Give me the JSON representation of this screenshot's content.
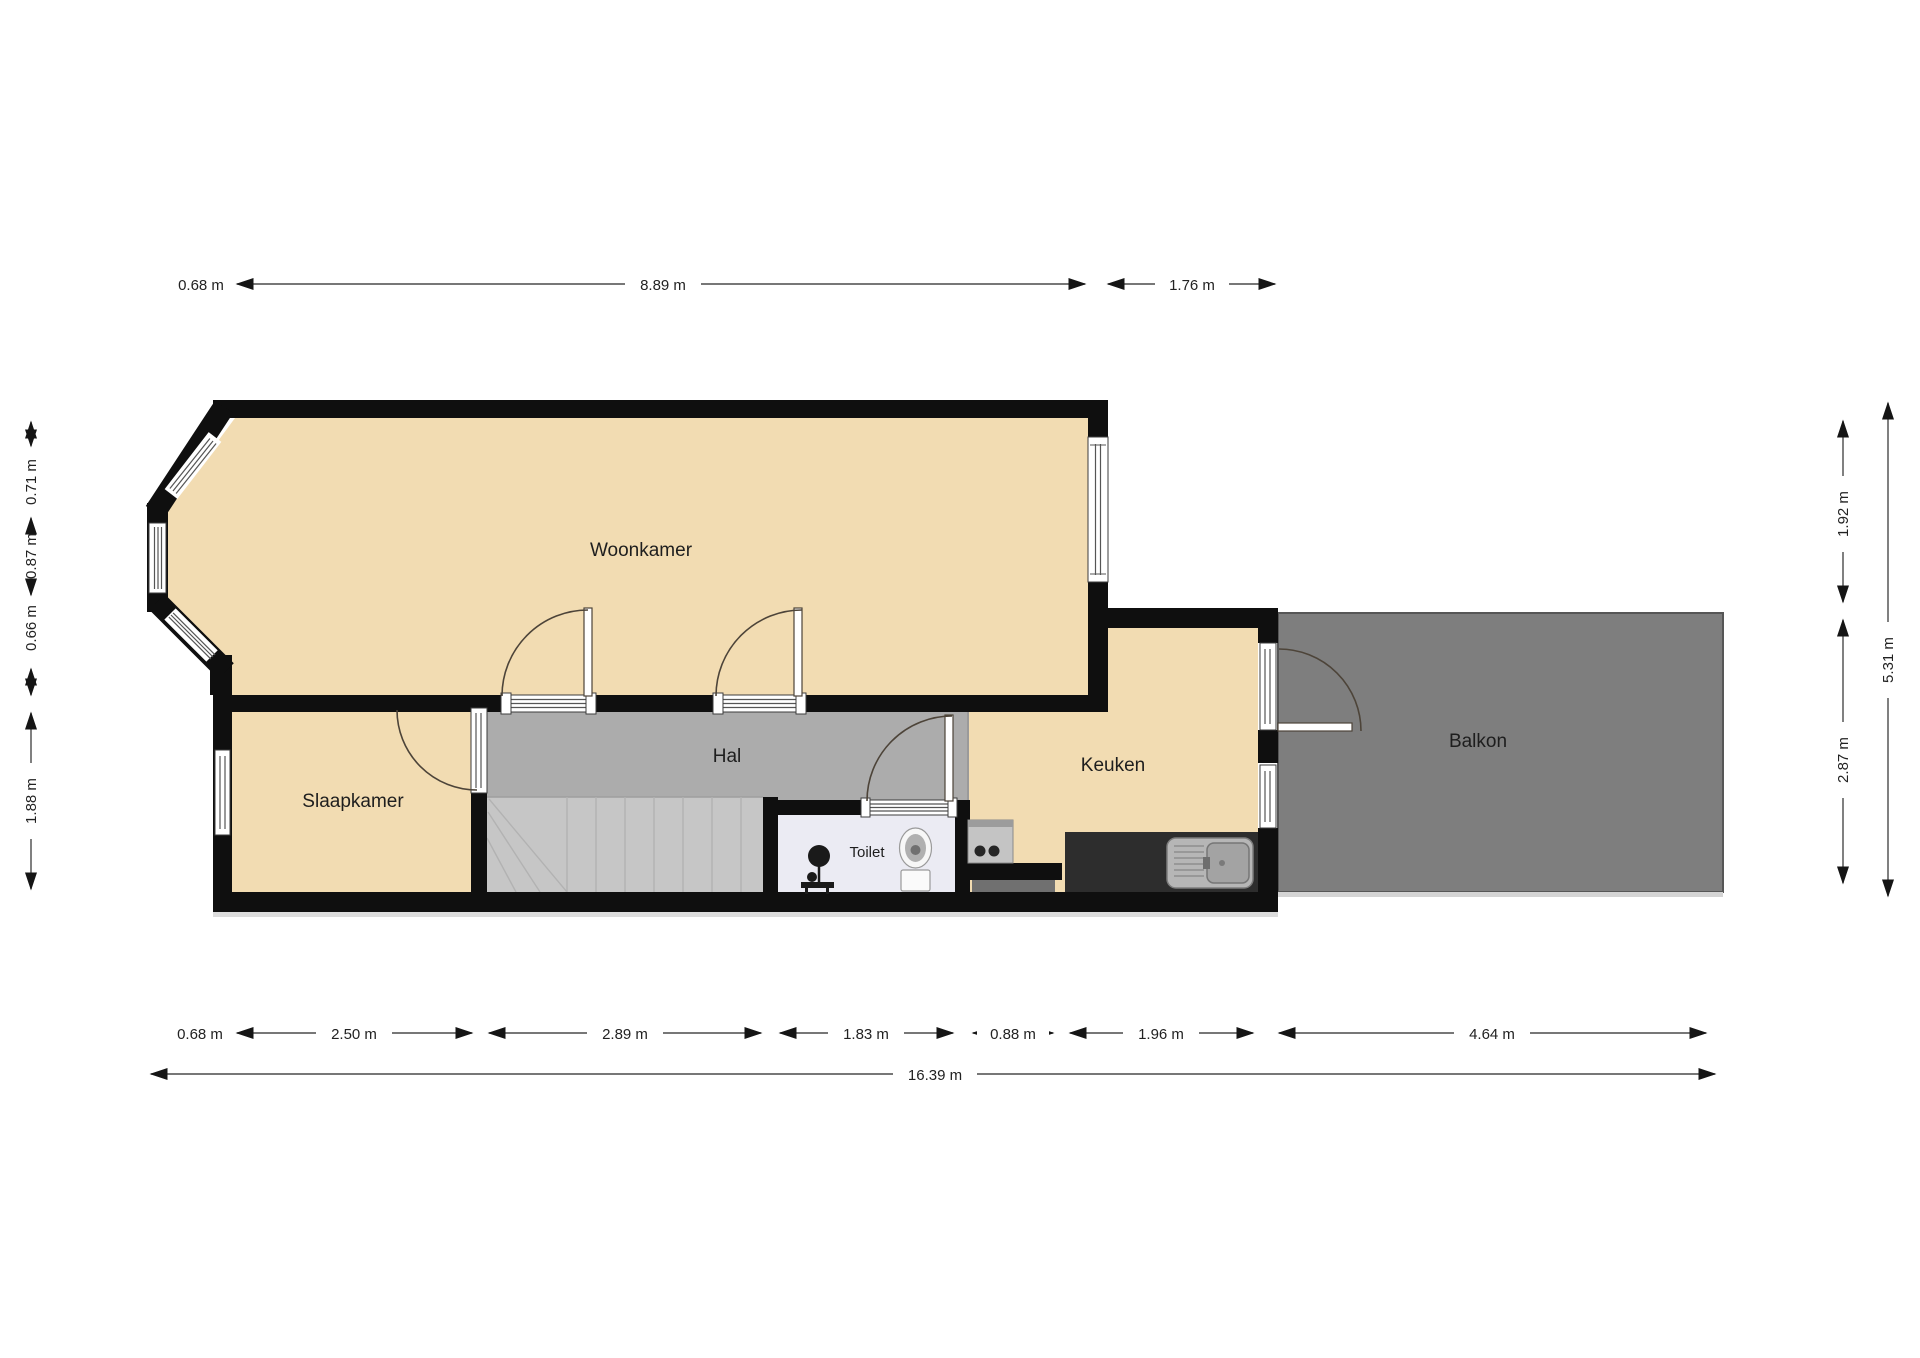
{
  "plan": {
    "type": "floorplan",
    "units": "m",
    "rooms": {
      "woonkamer": "Woonkamer",
      "slaapkamer": "Slaapkamer",
      "hal": "Hal",
      "toilet": "Toilet",
      "keuken": "Keuken",
      "balkon": "Balkon"
    },
    "dimensions": {
      "top": [
        {
          "label": "0.68 m",
          "value": 0.68
        },
        {
          "label": "8.89 m",
          "value": 8.89
        },
        {
          "label": "1.76 m",
          "value": 1.76
        }
      ],
      "bottom": [
        {
          "label": "0.68 m",
          "value": 0.68
        },
        {
          "label": "2.50 m",
          "value": 2.5
        },
        {
          "label": "2.89 m",
          "value": 2.89
        },
        {
          "label": "1.83 m",
          "value": 1.83
        },
        {
          "label": "0.88 m",
          "value": 0.88
        },
        {
          "label": "1.96 m",
          "value": 1.96
        },
        {
          "label": "4.64 m",
          "value": 4.64
        }
      ],
      "bottom_total": {
        "label": "16.39 m",
        "value": 16.39
      },
      "left": [
        {
          "label": "0.71 m",
          "value": 0.71
        },
        {
          "label": "0.87 m",
          "value": 0.87
        },
        {
          "label": "0.66 m",
          "value": 0.66
        },
        {
          "label": "1.88 m",
          "value": 1.88
        }
      ],
      "right": [
        {
          "label": "1.92 m",
          "value": 1.92
        },
        {
          "label": "2.87 m",
          "value": 2.87
        },
        {
          "label": "5.31 m",
          "value": 5.31
        }
      ]
    },
    "fixtures": [
      "staircase",
      "toilet-bowl",
      "washbasin",
      "kitchen-sink",
      "appliance"
    ],
    "colors": {
      "wall": "#0f0f0f",
      "room_floor": "#f2dcb2",
      "hall_floor": "#acacac",
      "stairs": "#c6c6c6",
      "toilet_floor": "#ebebf3",
      "balcony": "#7e7e7e",
      "counter": "#2d2d2d",
      "dimension_line": "#4a4a4a"
    }
  }
}
